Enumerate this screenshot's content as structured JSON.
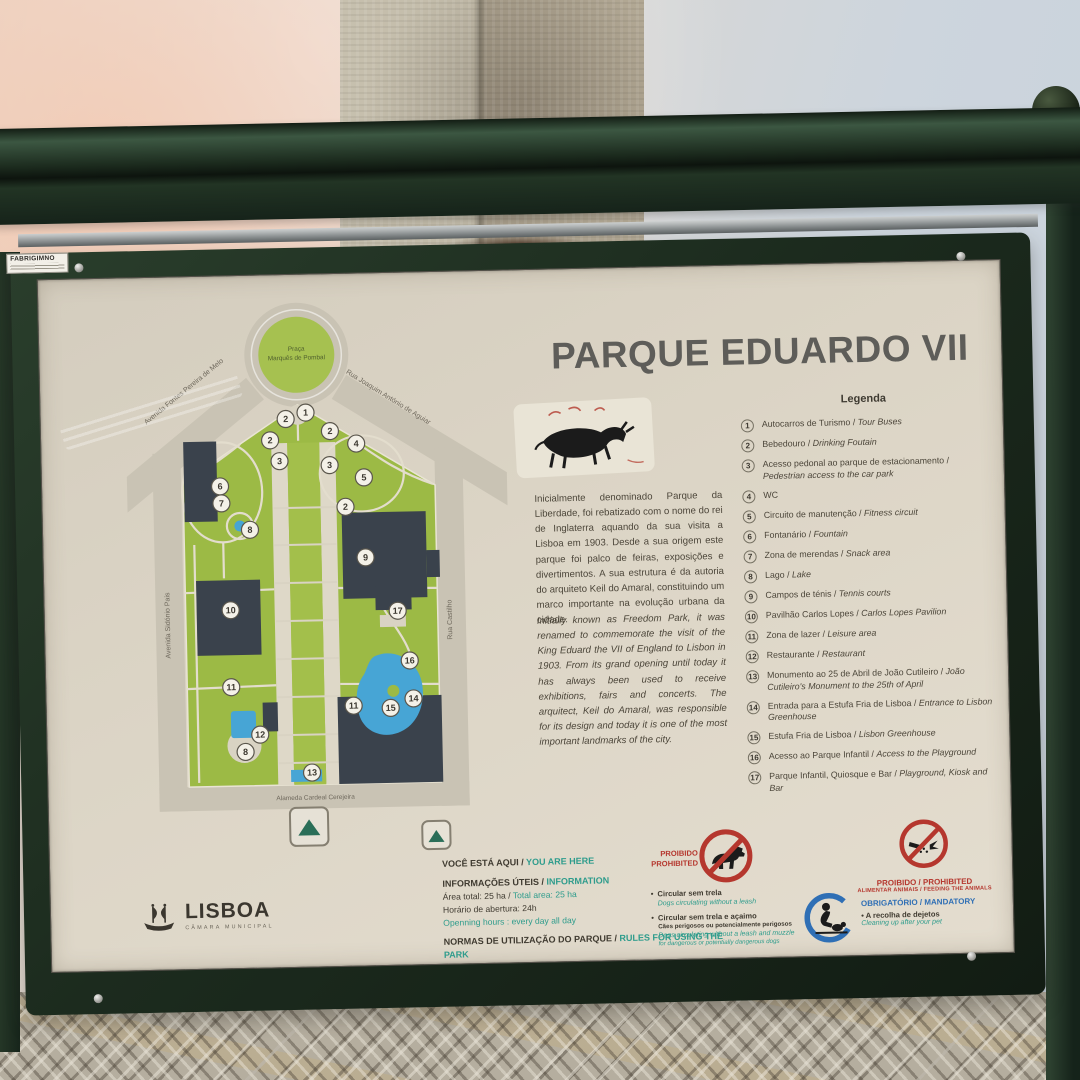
{
  "sign": {
    "title": "PARQUE EDUARDO VII",
    "sticker": "FABRIGIMNO",
    "description_pt": "Inicialmente denominado Parque da Liberdade, foi rebatizado com o nome do rei de Inglaterra aquando da sua visita a Lisboa em 1903. Desde a sua origem este parque foi palco de feiras, exposições e divertimentos. A sua estrutura é da autoria do arquiteto Keil do Amaral, constituindo um marco importante na evolução urbana da cidade.",
    "description_en": "Initially known as Freedom Park, it was renamed to commemorate the visit of the King Eduard the VII of England to Lisbon in 1903. From its grand opening until today it has always been used to receive exhibitions, fairs and concerts. The arquitect, Keil do Amaral, was responsible for its design and today it is one of the most important landmarks of the city.",
    "legend": {
      "header": "Legenda",
      "items": [
        {
          "num": "1",
          "pt": "Autocarros de Turismo",
          "en": "Tour Buses"
        },
        {
          "num": "2",
          "pt": "Bebedouro",
          "en": "Drinking Foutain"
        },
        {
          "num": "3",
          "pt": "Acesso pedonal ao parque de estacionamento",
          "en": "Pedestrian access to the car park"
        },
        {
          "num": "4",
          "pt": "WC",
          "en": ""
        },
        {
          "num": "5",
          "pt": "Circuito de manutenção",
          "en": "Fitness circuit"
        },
        {
          "num": "6",
          "pt": "Fontanário",
          "en": "Fountain"
        },
        {
          "num": "7",
          "pt": "Zona de merendas",
          "en": "Snack area"
        },
        {
          "num": "8",
          "pt": "Lago",
          "en": "Lake"
        },
        {
          "num": "9",
          "pt": "Campos de ténis",
          "en": "Tennis courts"
        },
        {
          "num": "10",
          "pt": "Pavilhão Carlos Lopes",
          "en": "Carlos Lopes Pavilion"
        },
        {
          "num": "11",
          "pt": "Zona de lazer",
          "en": "Leisure area"
        },
        {
          "num": "12",
          "pt": "Restaurante",
          "en": "Restaurant"
        },
        {
          "num": "13",
          "pt": "Monumento ao 25 de Abril de João Cutileiro",
          "en": "João Cutileiro's Monument to the 25th of April"
        },
        {
          "num": "14",
          "pt": "Entrada para a Estufa Fria de Lisboa",
          "en": "Entrance to Lisbon Greenhouse"
        },
        {
          "num": "15",
          "pt": "Estufa Fria de Lisboa",
          "en": "Lisbon Greenhouse"
        },
        {
          "num": "16",
          "pt": "Acesso ao Parque Infantil",
          "en": "Access to the Playground"
        },
        {
          "num": "17",
          "pt": "Parque Infantil, Quiosque e Bar",
          "en": "Playground, Kiosk and Bar"
        }
      ]
    },
    "map": {
      "praca_line1": "Praça",
      "praca_line2": "Marquês de Pombal",
      "streets": {
        "fontes": "Avenida Fontes Pereira de Melo",
        "joaquim": "Rua Joaquim António de Aguiar",
        "sidonio": "Avenida Sidónio Pais",
        "castilho": "Rua Castilho",
        "alameda": "Alameda Cardeal Cerejeira"
      },
      "markers": [
        {
          "n": "1",
          "x": 180,
          "y": 120
        },
        {
          "n": "2",
          "x": 160,
          "y": 126
        },
        {
          "n": "2",
          "x": 144,
          "y": 147
        },
        {
          "n": "2",
          "x": 204,
          "y": 139
        },
        {
          "n": "3",
          "x": 153,
          "y": 168
        },
        {
          "n": "3",
          "x": 203,
          "y": 173
        },
        {
          "n": "4",
          "x": 230,
          "y": 152
        },
        {
          "n": "5",
          "x": 237,
          "y": 186
        },
        {
          "n": "2",
          "x": 218,
          "y": 215
        },
        {
          "n": "6",
          "x": 93,
          "y": 192
        },
        {
          "n": "7",
          "x": 94,
          "y": 209
        },
        {
          "n": "8",
          "x": 122,
          "y": 236
        },
        {
          "n": "9",
          "x": 237,
          "y": 266
        },
        {
          "n": "10",
          "x": 101,
          "y": 316
        },
        {
          "n": "17",
          "x": 268,
          "y": 320
        },
        {
          "n": "16",
          "x": 279,
          "y": 370
        },
        {
          "n": "11",
          "x": 100,
          "y": 393
        },
        {
          "n": "14",
          "x": 282,
          "y": 408
        },
        {
          "n": "11",
          "x": 222,
          "y": 414
        },
        {
          "n": "15",
          "x": 259,
          "y": 417
        },
        {
          "n": "12",
          "x": 128,
          "y": 441
        },
        {
          "n": "8",
          "x": 113,
          "y": 458
        },
        {
          "n": "13",
          "x": 179,
          "y": 480
        }
      ]
    },
    "info": {
      "you_are_here_pt": "VOCÊ ESTÁ AQUI /",
      "you_are_here_en": "YOU ARE HERE",
      "useful_pt": "INFORMAÇÕES ÚTEIS /",
      "useful_en": "INFORMATION",
      "lines": [
        {
          "pt": "Área total: 25 ha /",
          "en": "Total area: 25 ha"
        },
        {
          "pt": "Horário de abertura: 24h",
          "en": ""
        },
        {
          "pt": "",
          "en": "Openning hours : every day all day"
        }
      ],
      "rules_header_pt": "NORMAS DE UTILIZAÇÃO DO PARQUE /",
      "rules_header_en": "RULES FOR USING THE PARK",
      "rules": [
        {
          "pt": "Não pise os canteiros /",
          "en": "Don't step on the flowerbeds"
        },
        {
          "pt": "Não colha ou danifique flores e plantas /",
          "en": "Don't cut or damage flowers and other plants"
        },
        {
          "pt": "Preserve a estatuária e o mobiliário urbano /",
          "en": "Preserve the statuary and urban furniture"
        }
      ]
    },
    "pictograms": {
      "no_dogs": {
        "title_pt": "PROIBIDO",
        "title_en": "PROHIBITED",
        "bullets": [
          {
            "pt": "Circular sem trela",
            "pt_small": "",
            "en": "Dogs circulating without a leash",
            "en_small": ""
          },
          {
            "pt": "Circular sem trela e açaimo",
            "pt_small": "Cães perigosos ou potencialmente perigosos",
            "en": "Dogs circulating without a leash and muzzle",
            "en_small": "for dangerous or potentially dangerous dogs"
          }
        ]
      },
      "no_feeding": {
        "title": "PROIBIDO / PROHIBITED",
        "subtitle": "ALIMENTAR ANIMAIS / FEEDING THE ANIMALS"
      },
      "mandatory": {
        "title": "OBRIGATÓRIO / MANDATORY",
        "line_pt": "• A recolha de dejetos",
        "line_en": "Cleaning up after your pet"
      }
    },
    "logo": {
      "name": "LISBOA",
      "subtitle": "CÂMARA MUNICIPAL"
    },
    "colors": {
      "accent_teal": "#2E9C8C",
      "prohibited_red": "#B5372E",
      "mandatory_blue": "#2F6FB5",
      "frame_green": "#22301F",
      "map_green": "#9CBA45",
      "water_blue": "#47A5D5",
      "building_gray": "#3A424C"
    }
  }
}
